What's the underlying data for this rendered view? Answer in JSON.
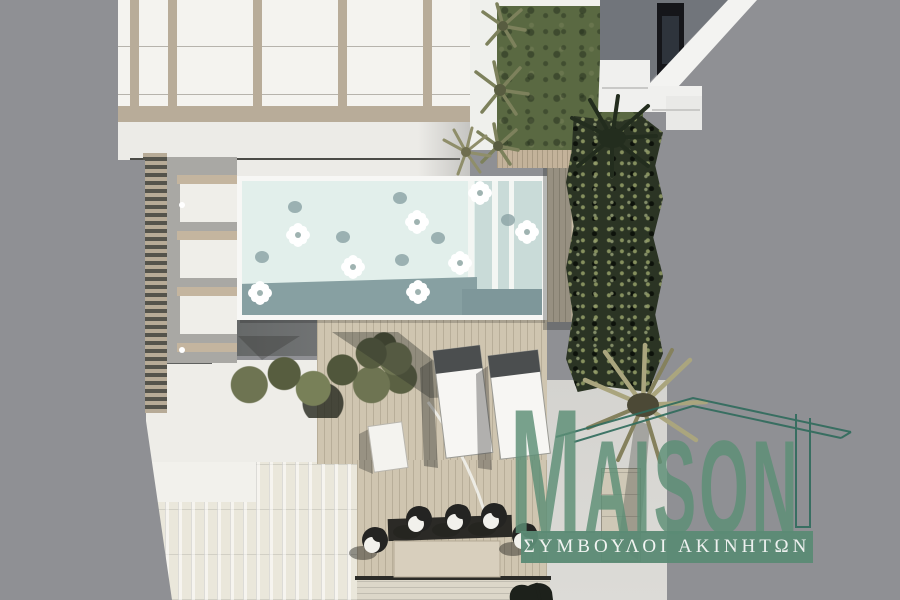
{
  "image": {
    "description": "Aerial 3D architectural rendering of a rooftop terrace: swimming pool with floats, pergola canopy, wooden sun deck with two loungers, round seating group, lawn, conifer hedge and palm trees",
    "background_color": "#8f9094"
  },
  "watermark": {
    "brand_initial": "M",
    "brand_rest": "AISON",
    "brand_full": "MAISON",
    "subtitle": "ΣΥΜΒΟΥΛΟΙ ΑΚΙΝΗΤΩΝ",
    "house_outline_icon": "house-roof-outline-icon"
  },
  "scene": {
    "pool_float_count": 8,
    "lounger_count": 2,
    "chair_count": 5
  },
  "colors": {
    "background": "#8f9094",
    "canopy": "#f4f3ef",
    "beam": "#b8ac99",
    "pool_water": "#e2efeb",
    "pool_band": "#87a0a2",
    "pool_rim": "#f7f7f5",
    "lawn": "#5a6942",
    "hedge": "#2b3424",
    "deck": "#cfc5b0",
    "tile_roof": "#eae7db",
    "patio": "#eeede8",
    "logo_green": "#5d8f76",
    "banner_green": "#5b8b75",
    "outline_green": "#2f6b5c",
    "subtitle_text": "#f3f6f4"
  }
}
